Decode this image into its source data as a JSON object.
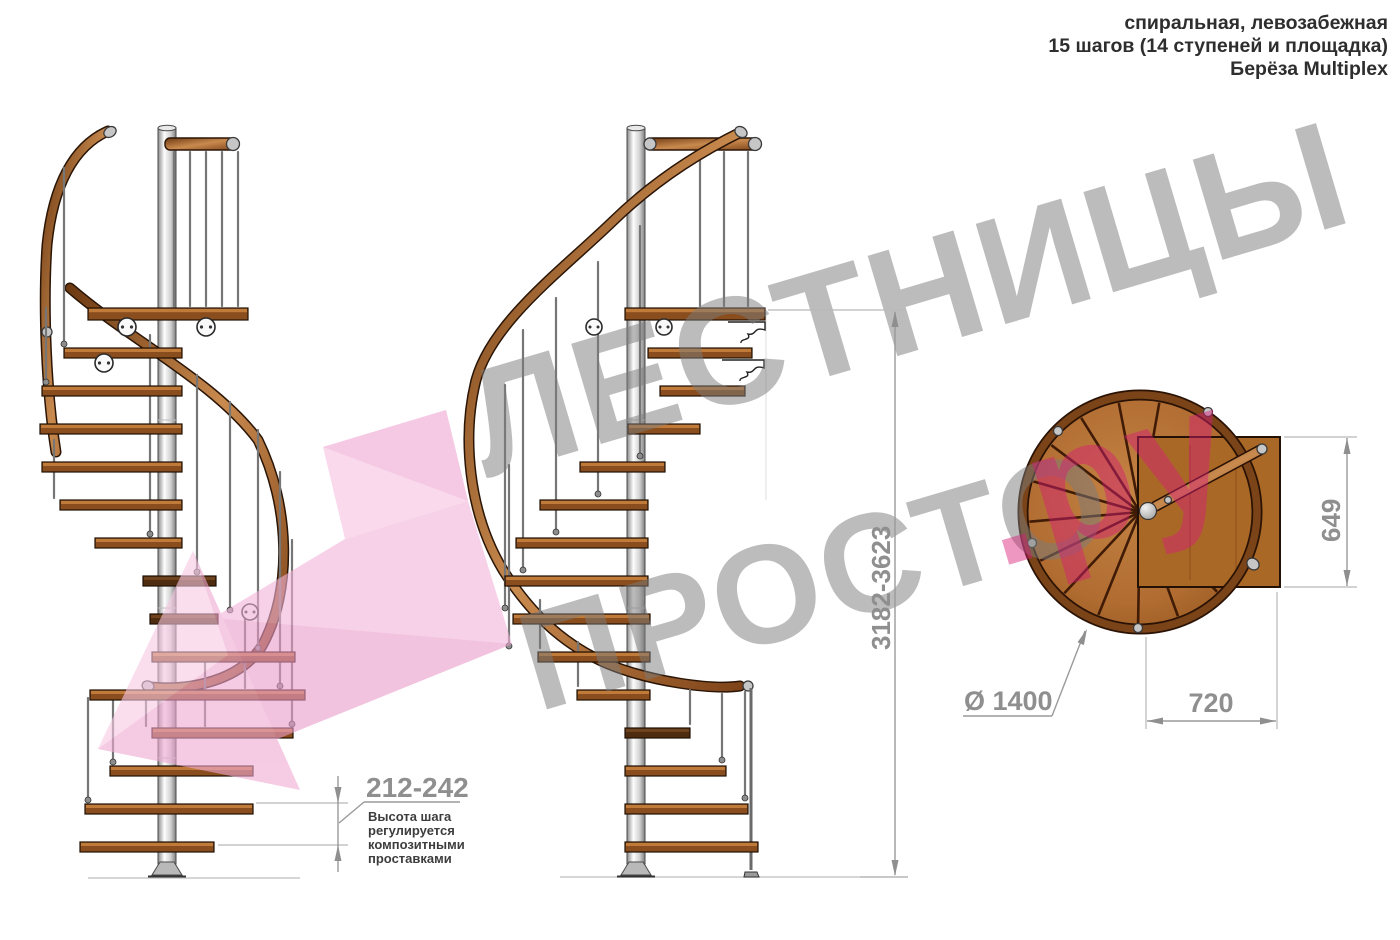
{
  "header": {
    "line1": "спиральная, левозабежная",
    "line2": "15 шагов (14 ступеней и площадка)",
    "line3": "Берёза Multiplex"
  },
  "watermark": {
    "word_top": "ЛЕСТНИЦЫ",
    "word_bottom": "ПРОСТО",
    "suffix": ".ру",
    "gray_color": "#7c7c7c",
    "pink_color": "#d81b77"
  },
  "annotations": {
    "total_height": {
      "value": "3182-3623"
    },
    "step_height": {
      "value": "212-242",
      "note_lines": [
        "Высота шага",
        "регулируется",
        "композитными",
        "проставками"
      ]
    },
    "diameter": {
      "label": "Ø 1400",
      "value": "1400"
    },
    "landing_width": {
      "value": "720"
    },
    "landing_depth": {
      "value": "649"
    }
  },
  "colors": {
    "accent_pink": "#f3b3d8",
    "wood": "#b06c31",
    "rail_copper": "#9a5524",
    "metal": "#c6c6c6",
    "dimension_gray": "#8f8f8f"
  }
}
